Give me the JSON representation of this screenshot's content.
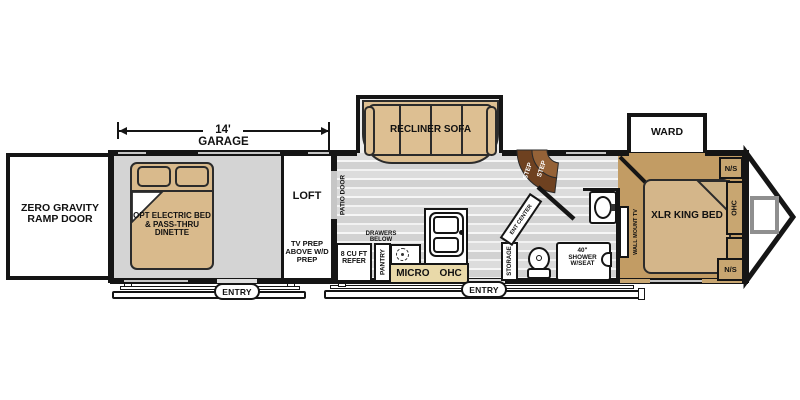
{
  "dimension": {
    "length": "14'",
    "label": "GARAGE"
  },
  "garage": {
    "ramp_door": "ZERO GRAVITY RAMP DOOR",
    "bed": "OPT ELECTRIC BED & PASS-THRU DINETTE",
    "entry_label": "ENTRY"
  },
  "loft": {
    "label": "LOFT",
    "prep": "TV PREP ABOVE W/D PREP",
    "patio_door": "PATIO DOOR"
  },
  "kitchen": {
    "sofa": "RECLINER SOFA",
    "refer": "8 CU FT REFER",
    "pantry": "PANTRY",
    "drawers": "DRAWERS BELOW",
    "micro": "MICRO",
    "ohc": "OHC",
    "entry_label": "ENTRY"
  },
  "hall": {
    "storage": "STORAGE",
    "ent_center": "ENT CENTER",
    "steps": [
      "STEP",
      "STEP"
    ]
  },
  "bath": {
    "shower": "40\" SHOWER W/SEAT"
  },
  "bedroom": {
    "ward": "WARD",
    "bed": "XLR KING BED",
    "tv": "WALL MOUNT TV",
    "ns_top": "N/S",
    "ns_bottom": "N/S",
    "ohc": "OHC"
  },
  "colors": {
    "furniture_tan": "#ddbf92",
    "bedroom_floor_tan": "#c29c64",
    "cabinet_tan": "#c8a671",
    "micro_banner_tan": "#e9d9a9",
    "step_dark_brown": "#6e4120",
    "step_light_brown": "#956237",
    "garage_floor_gray": "#d4d4d4",
    "wall_black": "#151515"
  }
}
